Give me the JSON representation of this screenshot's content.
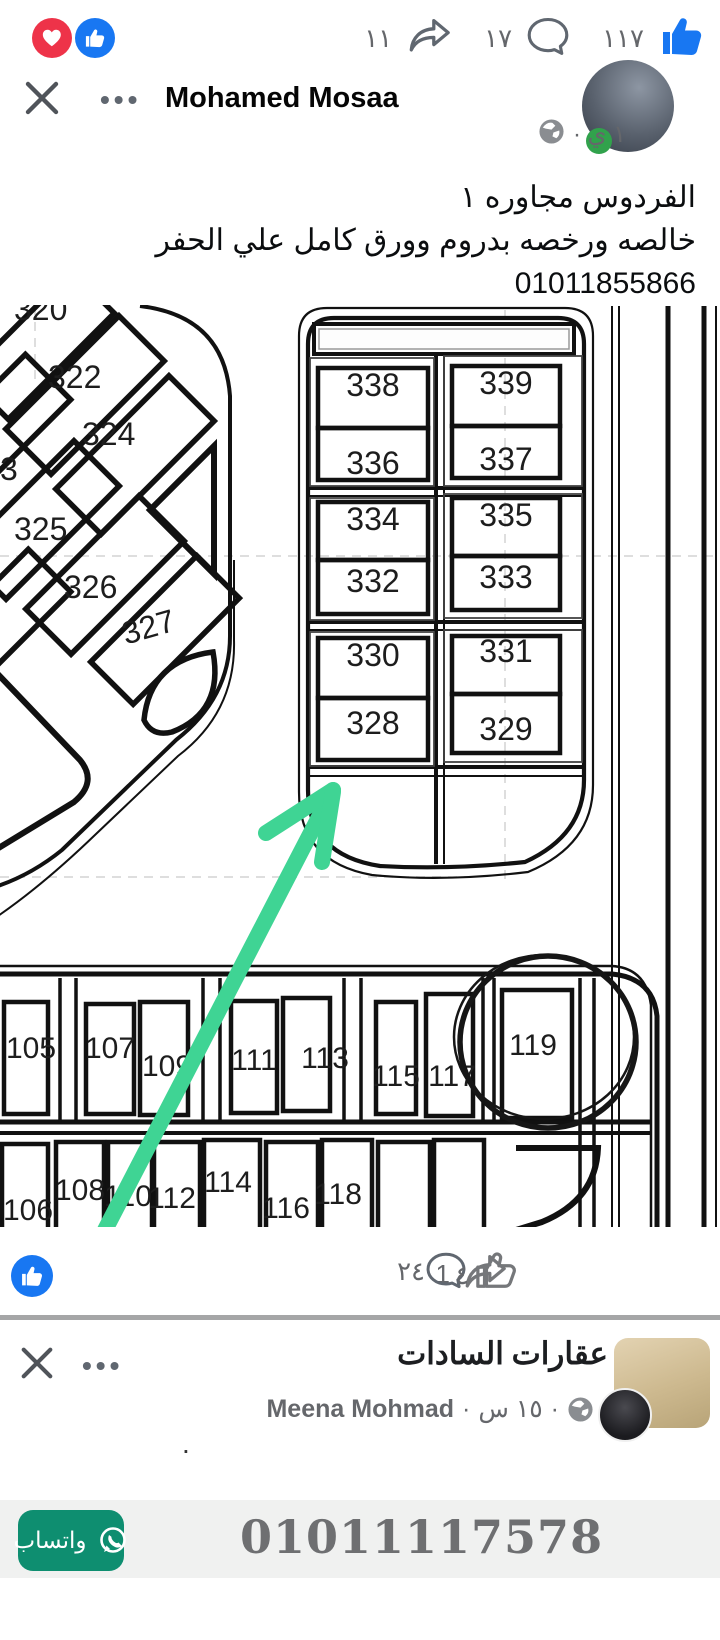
{
  "post1": {
    "reactions": {
      "love_color": "#ee3349",
      "like_color": "#1877f2"
    },
    "top_counts": {
      "shares": "١١",
      "comments": "١٧",
      "likes": "١١٧"
    },
    "close_label": "✕",
    "menu_label": "•••",
    "author": "Mohamed Mosaa",
    "timestamp": "١ ي ·",
    "text_line1": "الفردوس مجاوره ١",
    "text_line2": "خالصه ورخصه بدروم وورق كامل علي الحفر",
    "text_line3": "01011855866",
    "bottom_counts": {
      "shares": "1",
      "comments": "٢٤",
      "likes": "٤"
    }
  },
  "map": {
    "left_block": {
      "p320": "320",
      "p322": "322",
      "p323": "3",
      "p324": "324",
      "p325": "325",
      "p326": "326",
      "p327": "327"
    },
    "right_block": {
      "r1l": "338",
      "r1r": "339",
      "r2l": "336",
      "r2r": "337",
      "r3l": "334",
      "r3r": "335",
      "r4l": "332",
      "r4r": "333",
      "r5l": "330",
      "r5r": "331",
      "r6l": "328",
      "r6r": "329"
    },
    "bottom_top_row": {
      "c1": "105",
      "c2": "107",
      "c3": "109",
      "c4": "111",
      "c5": "113",
      "c6": "115",
      "c7": "117",
      "c8": "119"
    },
    "bottom_bottom_row": {
      "c1": "106",
      "c2": "108",
      "c3": "110",
      "c4": "112",
      "c5": "114",
      "c6": "116",
      "c7": "118"
    },
    "highlight": {
      "circled_plot": "119",
      "arrow_points_to": "328",
      "arrow_color": "#3fd494"
    }
  },
  "post2": {
    "close_label": "✕",
    "menu_label": "•••",
    "page_name": "عقارات السادات",
    "poster_name": "Meena Mohmad",
    "sep": "·",
    "timestamp": "١٥ س",
    "body": ".",
    "whatsapp_label": "واتساب",
    "phone": "01011117578"
  }
}
